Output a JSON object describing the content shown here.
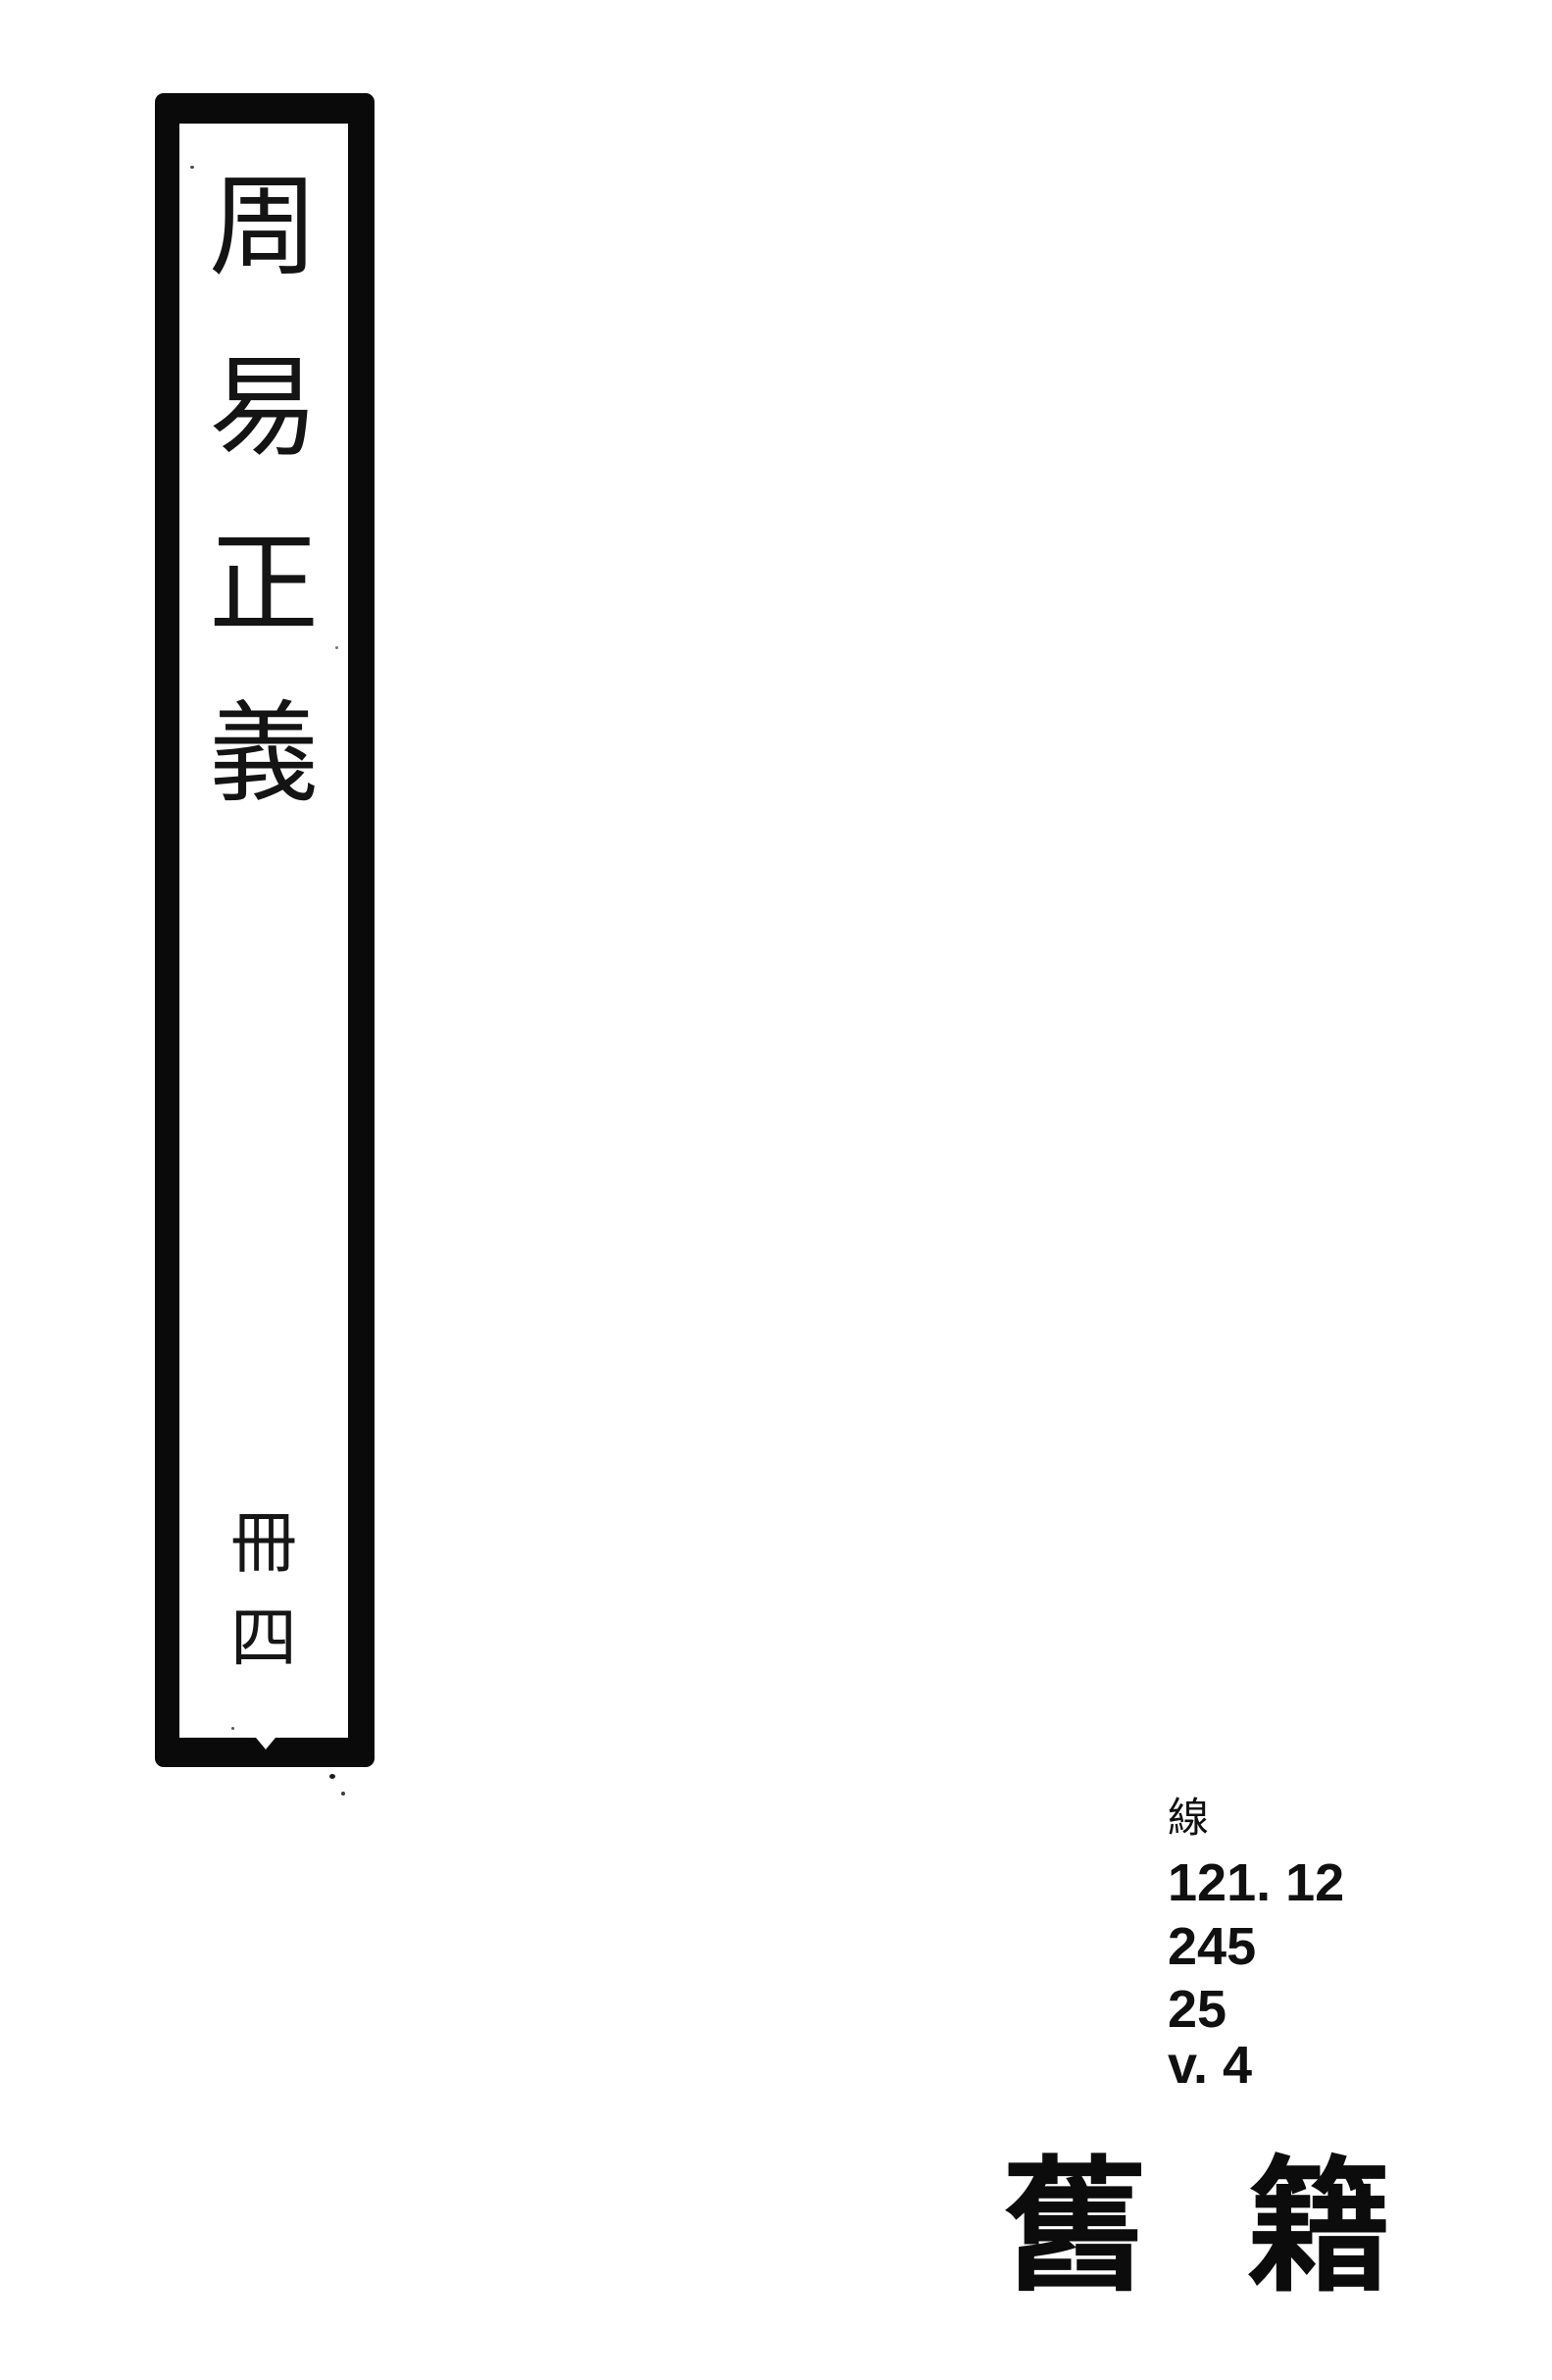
{
  "colors": {
    "paper": "#ffffff",
    "ink": "#0d0d0d"
  },
  "spine_label": {
    "title_text": "周易正義",
    "title_chars": [
      "周",
      "易",
      "正",
      "義"
    ],
    "volume_text": "冊四",
    "volume_chars": [
      "冊",
      "四"
    ]
  },
  "call_number": {
    "prefix_char": "線",
    "lines": [
      "121. 12",
      "245",
      "25",
      "v. 4"
    ]
  },
  "collection_mark": {
    "text": "舊籍",
    "chars": [
      "舊",
      "籍"
    ]
  }
}
